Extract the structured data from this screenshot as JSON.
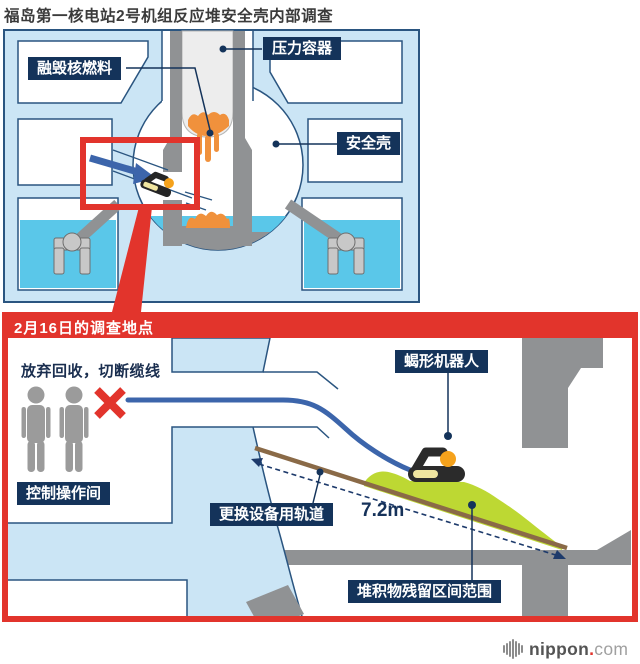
{
  "title": "福岛第一核电站2号机组反应堆安全壳内部调查",
  "top_diagram": {
    "label_melted_fuel": "融毁核燃料",
    "label_pressure_vessel": "压力容器",
    "label_containment_vessel": "安全壳"
  },
  "bottom_panel": {
    "header": "2月16日的调查地点",
    "note_cable_cut": "放弃回收，切断缆线",
    "label_scorpion_robot": "蝎形机器人",
    "label_control_room": "控制操作间",
    "label_equipment_rail": "更换设备用轨道",
    "distance_label": "7.2m",
    "label_deposits_range": "堆积物残留区间范围"
  },
  "footer": {
    "logo_bold": "nippon",
    "logo_dot": ".",
    "logo_light": "com"
  },
  "colors": {
    "red_accent": "#e2342c",
    "navy_label_bg": "#14335a",
    "panel_blue": "#cbe5f5",
    "outline_navy": "#2a5580",
    "water_cyan": "#5ac7e9",
    "structure_gray": "#909294",
    "cable_blue": "#3c65ab",
    "rail_brown": "#8a6a47",
    "deposit_green": "#bdd833",
    "corium_orange": "#f0913c",
    "robot_orange": "#f5a21c"
  }
}
